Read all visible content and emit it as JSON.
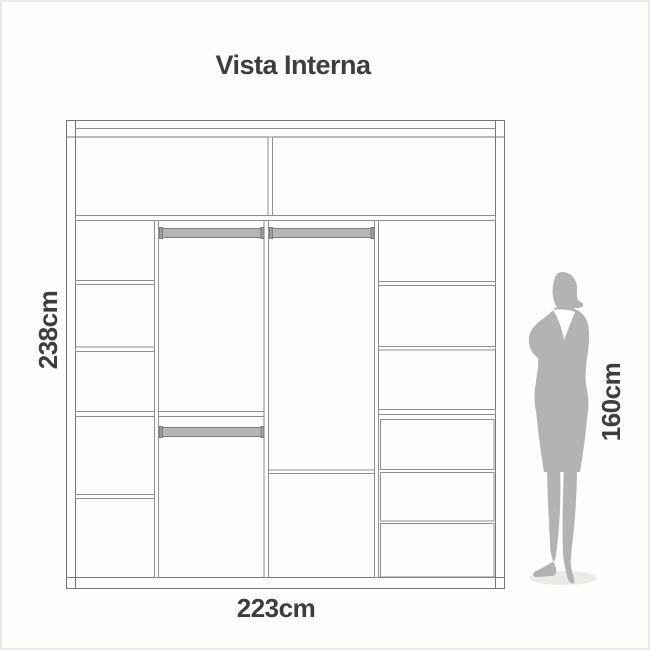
{
  "title": "Vista Interna",
  "labels": {
    "wardrobe_height": "238cm",
    "wardrobe_width": "223cm",
    "person_height": "160cm"
  },
  "colors": {
    "text": "#3d3d3d",
    "frame_line": "#767676",
    "inner_line": "#8f8f8f",
    "rod_fill": "#b6b6b6",
    "rod_cap": "#9e9e9e",
    "silhouette": "#b3b3b3",
    "collar": "#ffffff",
    "shadow": "#eaeae7",
    "background": "#fdfdfc"
  }
}
